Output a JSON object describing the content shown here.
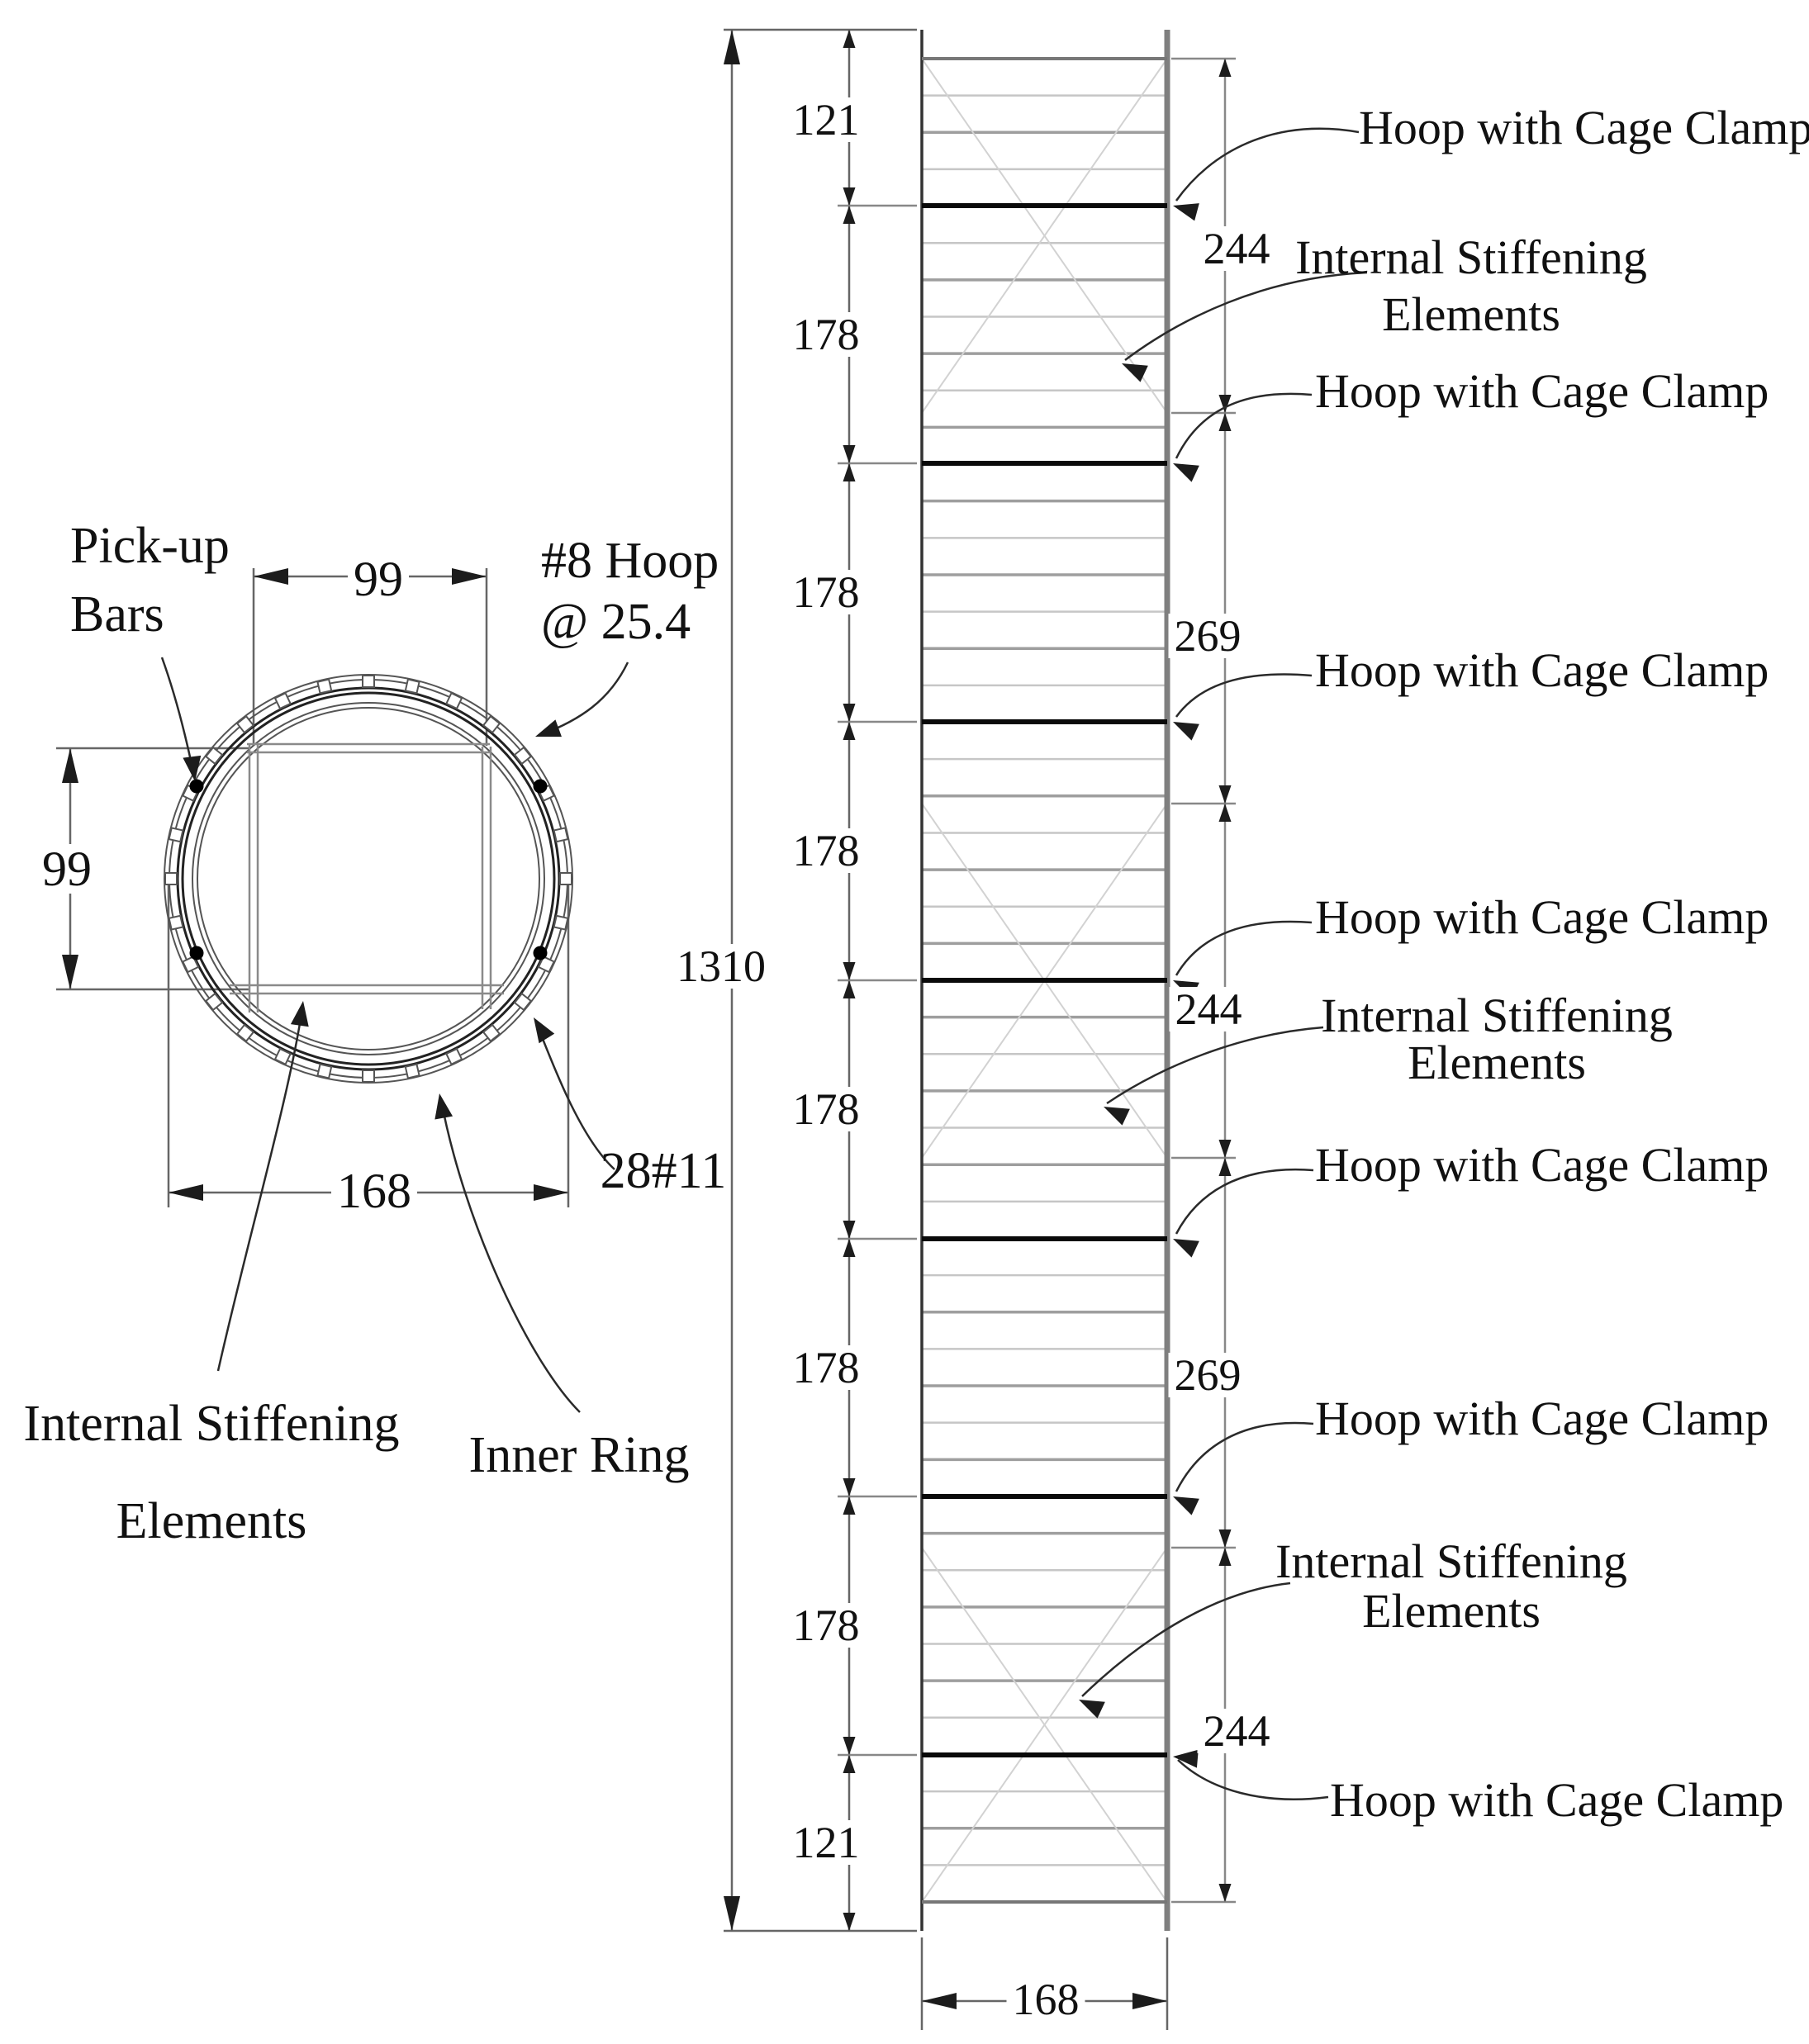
{
  "cross_section": {
    "pickup_bars_label_line1": "Pick-up",
    "pickup_bars_label_line2": "Bars",
    "hoop_spec_line1": "#8 Hoop",
    "hoop_spec_line2": "@ 25.4",
    "width_dim": "99",
    "height_dim": "99",
    "outer_diameter_dim": "168",
    "longitudinal_bars_label": "28#11",
    "inner_ring_label": "Inner Ring",
    "ise_label_line1": "Internal Stiffening",
    "ise_label_line2": "Elements"
  },
  "elevation": {
    "overall_height_dim": "1310",
    "width_dim": "168",
    "left_segment_dims": [
      "121",
      "178",
      "178",
      "178",
      "178",
      "178",
      "178",
      "121"
    ],
    "right_segment_dims": [
      "244",
      "269",
      "244",
      "269",
      "244"
    ],
    "hoop_clamp_label": "Hoop with Cage Clamp",
    "ise_label_line1": "Internal Stiffening",
    "ise_label_line2": "Elements"
  }
}
